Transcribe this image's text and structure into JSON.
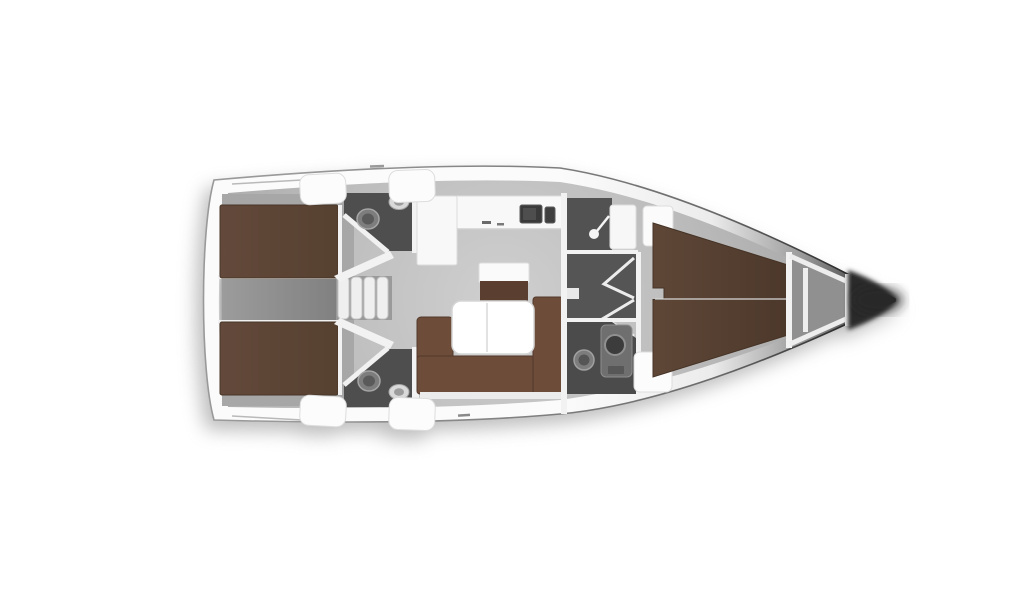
{
  "diagram": {
    "type": "yacht-interior-floor-plan",
    "orientation": "bow-right",
    "background": "#ffffff"
  },
  "colors": {
    "hull_band": "#fbfbfb",
    "hull_edge": "#8f8f8f",
    "bow_dark": "#2a2a2a",
    "floor_base": "#b9b9b9",
    "cabin_floor": "#a7a7a7",
    "corridor_gray": "#8c8c8c",
    "stairwell_gray": "#9a9a9a",
    "head_floor": "#4e4e4e",
    "shower_floor": "#525252",
    "passage_floor": "#555555",
    "bed_brown": "#5d4639",
    "bed_brown_dark": "#4f3a2c",
    "sofa_brown": "#6d4c39",
    "cabinet_brown": "#5a3e2f",
    "counter_white": "#f8f8f8",
    "table_white": "#ffffff",
    "wall_white": "#f2f2f2",
    "fixture_gray": "#7d7d7d",
    "sink_dark": "#3a3a3a",
    "locker_gray": "#909090",
    "seat_white": "#fcfcfc"
  },
  "rooms": [
    {
      "id": "aft-cabin-port",
      "label": "Aft double cabin (port)"
    },
    {
      "id": "aft-cabin-starboard",
      "label": "Aft double cabin (starboard)"
    },
    {
      "id": "aft-head-port",
      "label": "Aft head with toilet and basin (port)"
    },
    {
      "id": "aft-head-starboard",
      "label": "Aft head with toilet and basin (starboard)"
    },
    {
      "id": "engine-corridor",
      "label": "Center corridor between aft cabins"
    },
    {
      "id": "companionway",
      "label": "Companionway steps"
    },
    {
      "id": "galley",
      "label": "L-shaped galley with sink and stove"
    },
    {
      "id": "salon",
      "label": "Salon with U-sofa and folding table"
    },
    {
      "id": "forward-head",
      "label": "Forward head with separate shower"
    },
    {
      "id": "forward-cabin",
      "label": "Forward V-berth cabin"
    },
    {
      "id": "anchor-locker",
      "label": "Forepeak anchor locker"
    },
    {
      "id": "bow",
      "label": "Bow"
    }
  ],
  "fixtures": [
    "toilet",
    "washbasin",
    "shower-head",
    "galley-sink",
    "stove",
    "salon-table",
    "u-sofa",
    "island-cabinet",
    "companionway-steps",
    "folding-door",
    "v-berth",
    "double-berth",
    "bulkhead",
    "deck-cushion"
  ]
}
